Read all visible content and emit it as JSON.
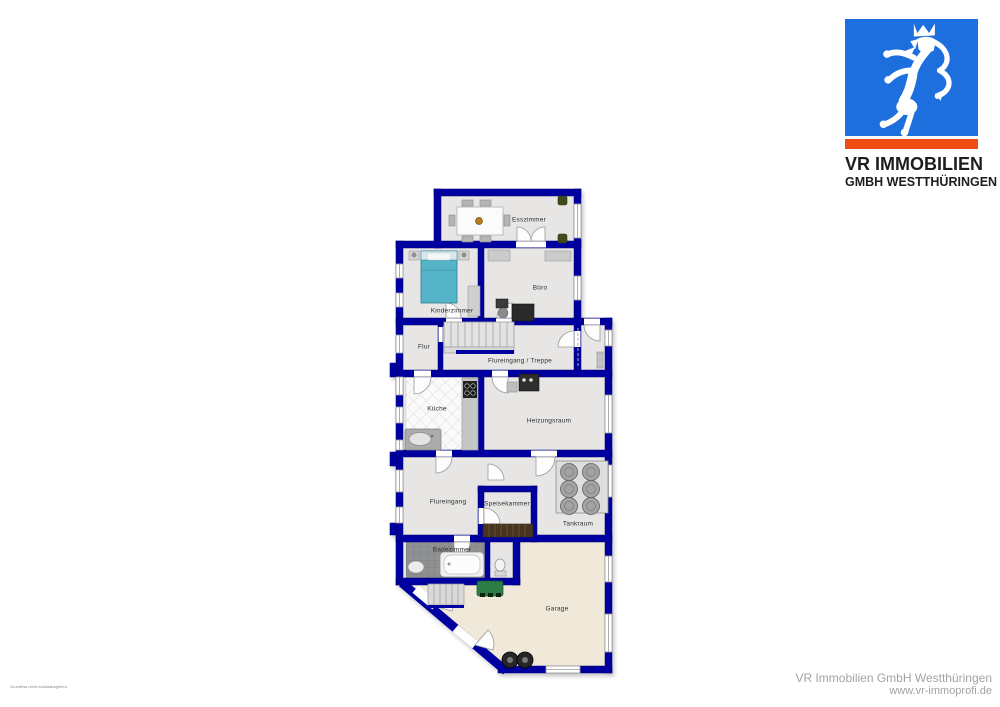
{
  "logo": {
    "name_line1": "VR IMMOBILIEN",
    "name_line2": "GMBH WESTTHÜRINGEN"
  },
  "floorplan": {
    "rooms": [
      {
        "id": "esszimmer",
        "label": "Esszimmer"
      },
      {
        "id": "kinderzimmer",
        "label": "Kinderzimmer"
      },
      {
        "id": "buero",
        "label": "Büro"
      },
      {
        "id": "flur",
        "label": "Flur"
      },
      {
        "id": "flureingang_treppe",
        "label": "Flureingang / Treppe"
      },
      {
        "id": "kueche",
        "label": "Küche"
      },
      {
        "id": "heizungsraum",
        "label": "Heizungsraum"
      },
      {
        "id": "flureingang",
        "label": "Flureingang"
      },
      {
        "id": "speisekammer",
        "label": "Speisekammer"
      },
      {
        "id": "tankraum",
        "label": "Tankraum"
      },
      {
        "id": "badezimmer",
        "label": "Badezimmer"
      },
      {
        "id": "garage",
        "label": "Garage"
      }
    ]
  },
  "footer": {
    "company": "VR Immobilien GmbH Westthüringen",
    "website": "www.vr-immoprofi.de",
    "disclaimer": "Grundriss nicht maßstabsgetreu"
  },
  "colors": {
    "wall_blue": "#0000A0",
    "brand_blue": "#1E6FDE",
    "brand_orange": "#F04E10",
    "floor_gray": "#E7E6E4",
    "garage_beige": "#F0E9DA",
    "bath_tile": "#8E9092",
    "bed_teal": "#57B4C8",
    "mower_green": "#2F7D46",
    "footer_gray": "#A3A3A3"
  }
}
